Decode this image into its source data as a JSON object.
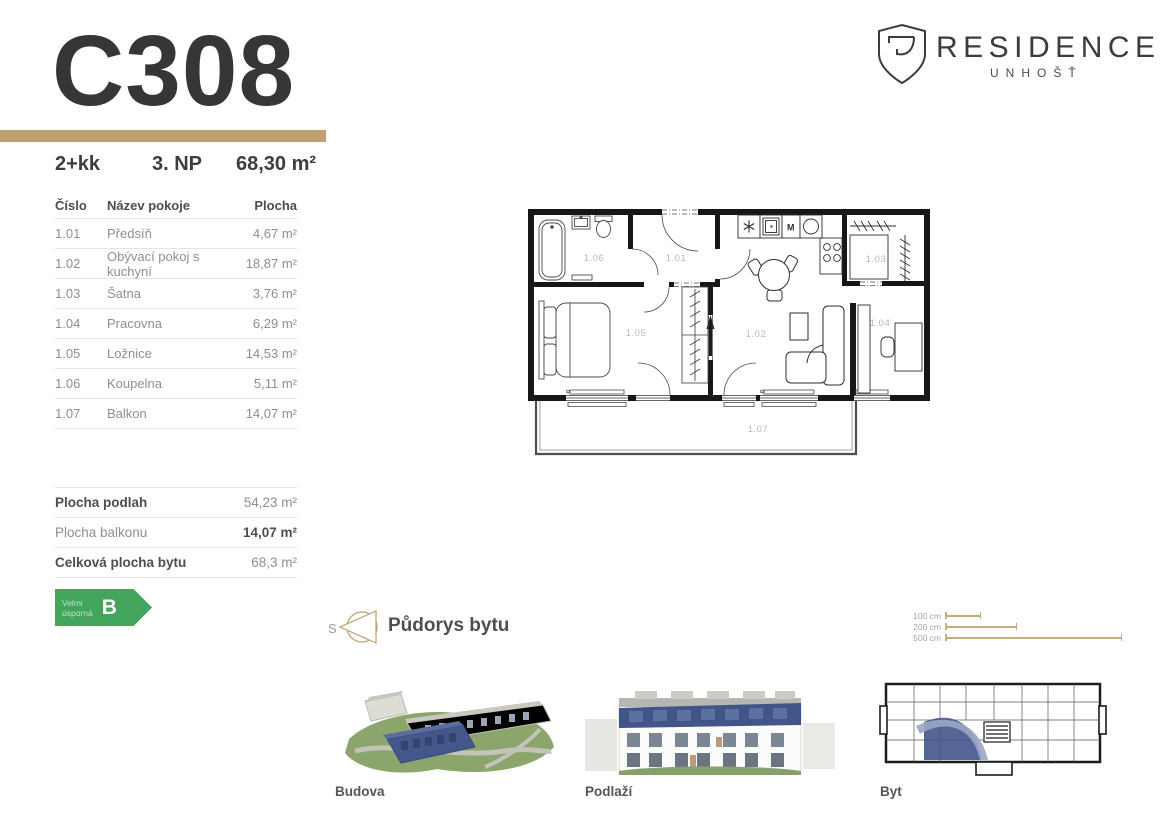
{
  "header": {
    "unit_code": "C308",
    "layout": "2+kk",
    "floor": "3. NP",
    "area": "68,30 m²"
  },
  "logo": {
    "brand": "RESIDENCE",
    "location": "UNHOŠŤ"
  },
  "table": {
    "headers": {
      "num": "Číslo",
      "name": "Název pokoje",
      "area": "Plocha"
    },
    "rows": [
      {
        "num": "1.01",
        "name": "Předsíň",
        "area": "4,67 m²"
      },
      {
        "num": "1.02",
        "name": "Obývací pokoj s kuchyní",
        "area": "18,87 m²"
      },
      {
        "num": "1.03",
        "name": "Šatna",
        "area": "3,76 m²"
      },
      {
        "num": "1.04",
        "name": "Pracovna",
        "area": "6,29 m²"
      },
      {
        "num": "1.05",
        "name": "Ložnice",
        "area": "14,53 m²"
      },
      {
        "num": "1.06",
        "name": "Koupelna",
        "area": "5,11 m²"
      },
      {
        "num": "1.07",
        "name": "Balkon",
        "area": "14,07 m²"
      }
    ]
  },
  "summary": {
    "rows": [
      {
        "label": "Plocha podlah",
        "value": "54,23 m²"
      },
      {
        "label": "Plocha balkonu",
        "value": "14,07 m²"
      },
      {
        "label": "Celková plocha bytu",
        "value": "68,3 m²"
      }
    ]
  },
  "energy": {
    "line1": "Velmi",
    "line2": "úsporná",
    "grade": "B"
  },
  "plan": {
    "caption": "Půdorys bytu",
    "compass_letter": "S",
    "labels": {
      "r101": "1.01",
      "r102": "1.02",
      "r103": "1.03",
      "r104": "1.04",
      "r105": "1.05",
      "r106": "1.06",
      "r107": "1.07"
    },
    "kitchen_mark_m": "M"
  },
  "scale": {
    "items": [
      {
        "label": "100 cm"
      },
      {
        "label": "200 cm"
      },
      {
        "label": "500 cm"
      }
    ]
  },
  "thumbnails": {
    "building": "Budova",
    "floor": "Podlaží",
    "unit": "Byt"
  },
  "colors": {
    "accent": "#bf9e6f",
    "energy_green": "#43a45c",
    "highlight_blue": "#42558b",
    "ink": "#363636",
    "muted": "#8f8f8f"
  }
}
